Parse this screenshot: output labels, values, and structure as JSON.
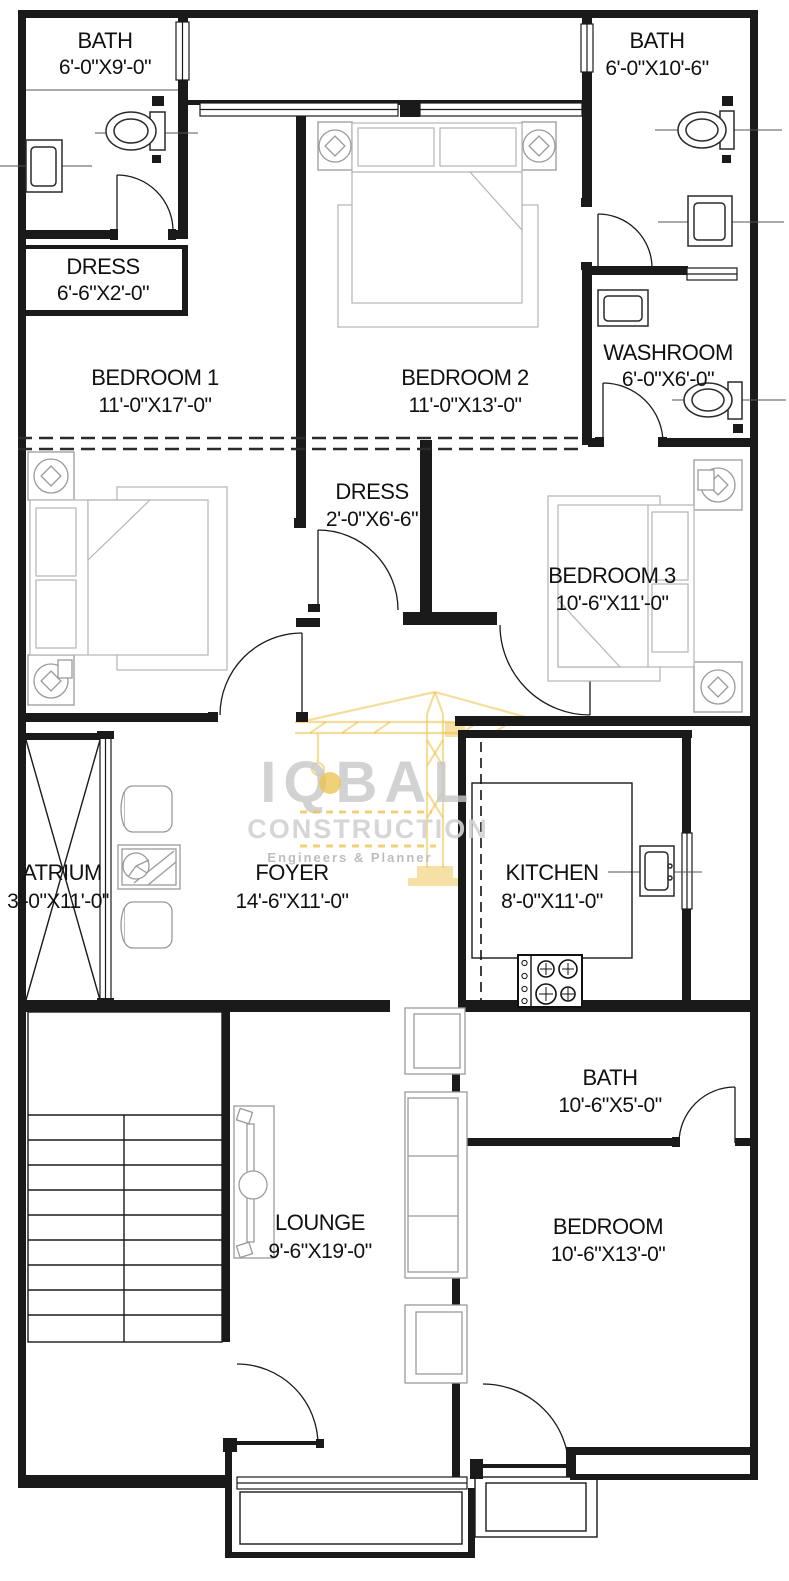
{
  "drawing": {
    "type": "residential-floor-plan",
    "units": "feet-inches"
  },
  "colors": {
    "wall": "#1a1a1a",
    "furniture": "#9a9a9a",
    "background": "#ffffff",
    "watermark_gray": "#c7c7c7",
    "watermark_yellow": "#ecc14b"
  },
  "watermark": {
    "line1": "IQBAL",
    "line2": "CONSTRUCTION",
    "line3": "Engineers & Planner"
  },
  "rooms": {
    "bath_top_left": {
      "name": "BATH",
      "dims": "6'-0\"X9'-0\""
    },
    "bath_top_right": {
      "name": "BATH",
      "dims": "6'-0\"X10'-6\""
    },
    "dress_top": {
      "name": "DRESS",
      "dims": "6'-6\"X2'-0\""
    },
    "bedroom1": {
      "name": "BEDROOM 1",
      "dims": "11'-0\"X17'-0\""
    },
    "bedroom2": {
      "name": "BEDROOM 2",
      "dims": "11'-0\"X13'-0\""
    },
    "washroom": {
      "name": "WASHROOM",
      "dims": "6'-0\"X6'-0\""
    },
    "dress_mid": {
      "name": "DRESS",
      "dims": "2'-0\"X6'-6\""
    },
    "bedroom3": {
      "name": "BEDROOM 3",
      "dims": "10'-6\"X11'-0\""
    },
    "atrium": {
      "name": "ATRIUM",
      "dims": "3'-0\"X11'-0\""
    },
    "foyer": {
      "name": "FOYER",
      "dims": "14'-6\"X11'-0\""
    },
    "kitchen": {
      "name": "KITCHEN",
      "dims": "8'-0\"X11'-0\""
    },
    "bath_mid": {
      "name": "BATH",
      "dims": "10'-6\"X5'-0\""
    },
    "bedroom_bottom": {
      "name": "BEDROOM",
      "dims": "10'-6\"X13'-0\""
    },
    "lounge": {
      "name": "LOUNGE",
      "dims": "9'-6\"X19'-0\""
    }
  }
}
